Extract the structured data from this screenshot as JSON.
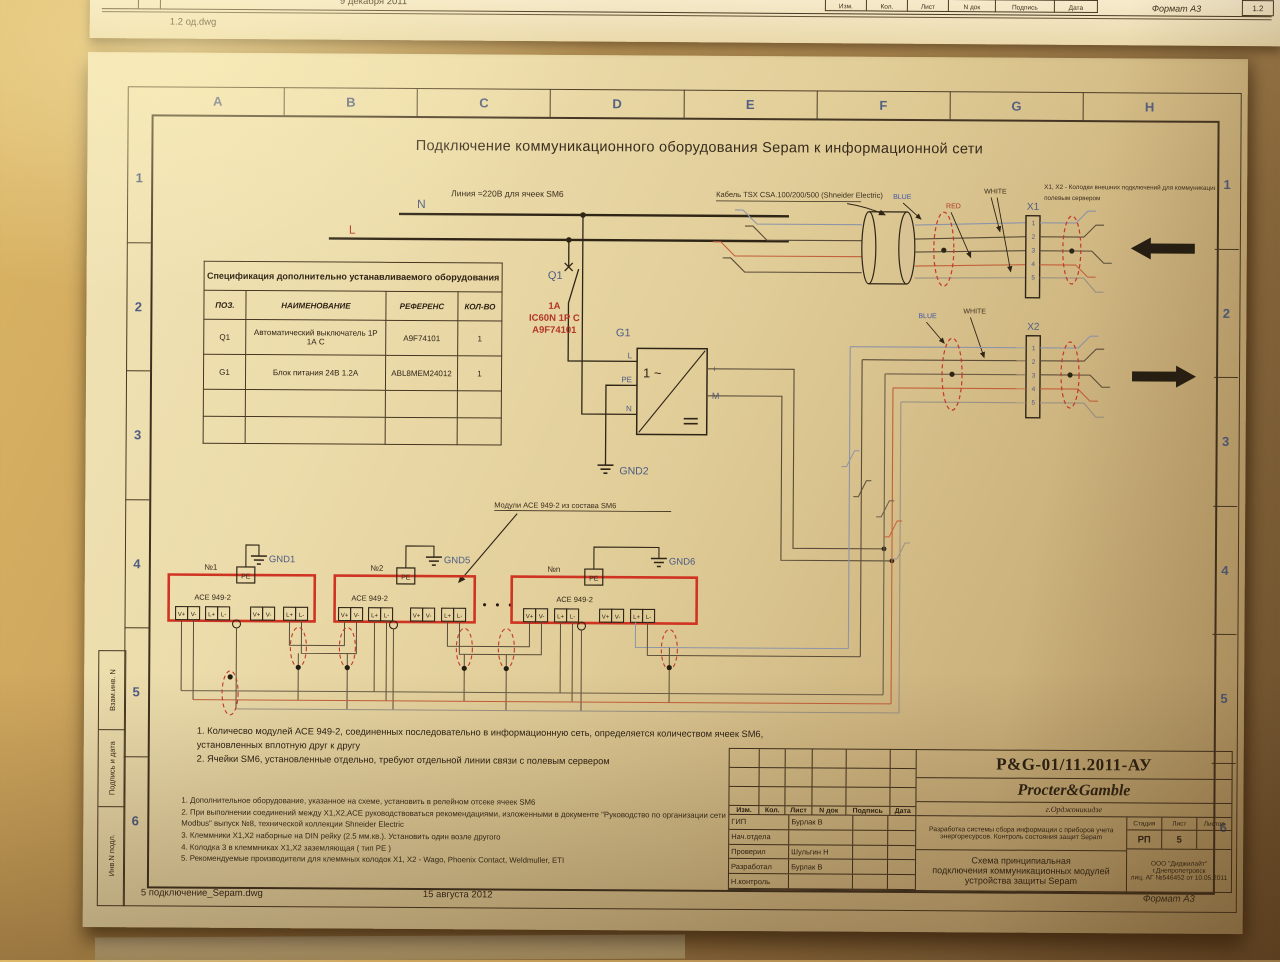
{
  "top_sheet": {
    "filename": "1.2 од.dwg",
    "date": "9 декабря 2011",
    "format": "Формат А3",
    "sheet_no": "1.2",
    "stamp_cols": [
      "Изм.",
      "Кол.",
      "Лист",
      "N док",
      "Подпись",
      "Дата"
    ]
  },
  "frame": {
    "cols": [
      "A",
      "B",
      "C",
      "D",
      "E",
      "F",
      "G",
      "H"
    ],
    "rows": [
      "1",
      "2",
      "3",
      "4",
      "5",
      "6"
    ],
    "stamps": [
      "Взам.инв. N",
      "Подпись и дата",
      "Инв.N подл."
    ]
  },
  "drawing": {
    "title": "Подключение коммуникационного оборудования Sepam к информационной сети",
    "spec": {
      "title": "Спецификация дополнительно устанавливаемого оборудования",
      "headers": [
        "ПОЗ.",
        "НАИМЕНОВАНИЕ",
        "РЕФЕРЕНС",
        "КОЛ-ВО"
      ],
      "rows": [
        [
          "Q1",
          "Автоматический выключатель 1Р\n1А С",
          "A9F74101",
          "1"
        ],
        [
          "G1",
          "Блок питания 24В 1.2А",
          "ABL8MEM24012",
          "1"
        ]
      ]
    },
    "labels": {
      "line220": "Линия ≈220В  для ячеек SM6",
      "N": "N",
      "L": "L",
      "Q1": "Q1",
      "q1_rating": "1А",
      "q1_type": "IC60N 1Р С",
      "q1_ref": "A9F74101",
      "G1": "G1",
      "g1_ac": "1 ~",
      "t_L": "L",
      "t_PE": "PE",
      "t_N": "N",
      "t_plus": "+",
      "t_M": "M",
      "gnd1": "GND1",
      "gnd2": "GND2",
      "gnd5": "GND5",
      "gnd6": "GND6",
      "cable": "Кабель  TSX CSA.100/200/500 (Shneider Electric)",
      "blue": "BLUE",
      "red": "RED",
      "white": "WHITE",
      "x1": "X1",
      "x2": "X2",
      "x_note1": "X1, X2 -  Колодки внешних подключений для  коммуникации с",
      "x_note2": "полевым сервером",
      "modules_note": "Модули АСЕ 949-2 из состава SM6",
      "dots": "•  •  •"
    },
    "modules": {
      "items": [
        "№1",
        "№2",
        "№n"
      ],
      "device": "АСЕ 949-2",
      "pe": "PE",
      "terminals": [
        "V+",
        "V-",
        "L+",
        "L-"
      ]
    },
    "pins": [
      "1",
      "2",
      "3",
      "4",
      "5"
    ],
    "notes_main": "1. Количесво модулей АСЕ 949-2, соединенных последовательно в информационную сеть, определяется  количеством ячеек SM6,\nустановленных вплотную друг к другу\n2. Ячейки SM6, установленные отдельно, требуют отдельной линии связи с полевым сервером",
    "notes_small": "1. Дополнительное оборудование, указанное на схеме, установить в релейном отсеке ячеек SM6\n2. При выполнении соединений между X1,X2,АСЕ  руководствоваться рекомендациями, изложенными  в документе \"Руководство по организации сети\nModbus\" выпуск №8, технической коллекции Shneider Electric\n3. Клеммники X1,X2 наборные на DIN рейку (2.5 мм.кв.). Установить один возле другого\n4. Колодка 3 в клеммниках X1,X2 заземляющая ( тип РЕ )\n5. Рекомендуемые производители для клеммных колодок X1, X2 - Wago, Phoenix Contact, Weldmuller, ETI"
  },
  "title_block": {
    "doc_no": "P&G-01/11.2011-АУ",
    "company": "Procter&Gamble",
    "city": "г.Орджоникидзе",
    "header_cols": [
      "Изм.",
      "Кол.",
      "Лист",
      "N док",
      "Подпись",
      "Дата"
    ],
    "sign_rows": [
      [
        "ГИП",
        "Бурлак В"
      ],
      [
        "Нач.отдела",
        ""
      ],
      [
        "Проверил",
        "Шульгин Н"
      ],
      [
        "Разработал",
        "Бурлак В"
      ],
      [
        "Н.контроль",
        ""
      ]
    ],
    "project_desc": "Разработка системы сбора информации с приборов учета\nэнергоресурсов. Контроль состояния защит Sepam",
    "stage_headers": [
      "Стадия",
      "Лист",
      "Листов"
    ],
    "stage_values": [
      "РП",
      "5",
      ""
    ],
    "sheet_title": "Схема принципиальная\nподключения коммуникационных модулей\nустройства защиты Sepam",
    "org": "ООО \"Диджилайт\"\nг.Днепропетровск\nлиц.  АГ №546452 от 10.05.2011"
  },
  "footer": {
    "filename": "5 подключение_Sepam.dwg",
    "date": "15 августа 2012",
    "format": "Формат А3"
  }
}
